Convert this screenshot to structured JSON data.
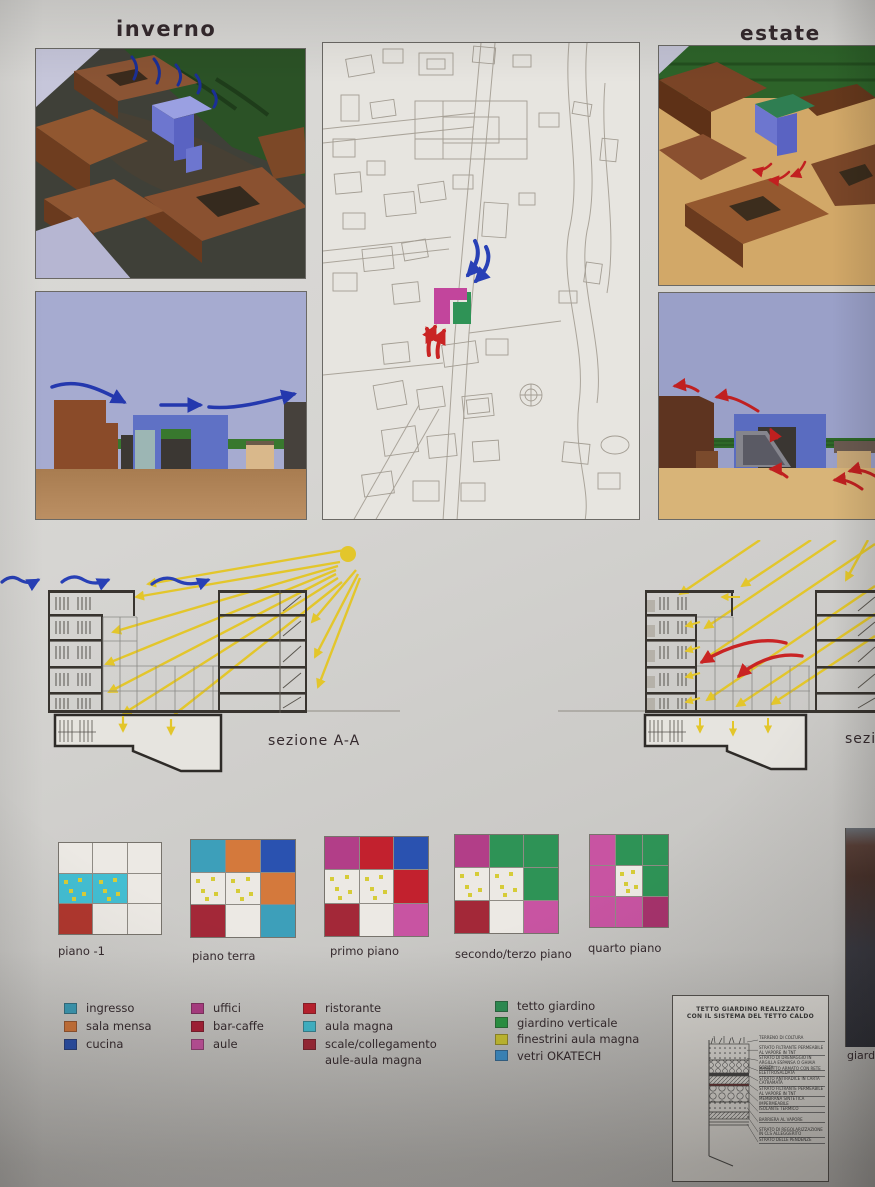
{
  "labels": {
    "winter": "inverno",
    "summer": "estate",
    "section_left": "sezione  A-A",
    "section_right": "sezione",
    "right_caption": "giardino verticale"
  },
  "floor_plans": {
    "plans": [
      {
        "label": "piano -1",
        "cells": [
          "white",
          "white",
          "white",
          "cyan*",
          "cyan*",
          "white",
          "brick",
          "white",
          "white"
        ]
      },
      {
        "label": "piano terra",
        "cells": [
          "teal",
          "orange",
          "blue",
          "white*",
          "white*",
          "orange",
          "darkred",
          "white",
          "teal"
        ]
      },
      {
        "label": "primo piano",
        "cells": [
          "magenta",
          "red",
          "blue",
          "white*",
          "white*",
          "red",
          "darkred",
          "white",
          "pink"
        ]
      },
      {
        "label": "secondo/terzo piano",
        "cells": [
          "magenta",
          "green",
          "green",
          "white*",
          "white*",
          "green",
          "darkred",
          "white",
          "pink"
        ]
      },
      {
        "label": "quarto piano",
        "cells": [
          "pink",
          "green",
          "green",
          "pink",
          "white*",
          "green",
          "pink",
          "pink",
          "plum"
        ]
      }
    ]
  },
  "palette": {
    "white": "#ece9e4",
    "teal": "#3d9fba",
    "orange": "#d4793c",
    "blue": "#2a52b0",
    "magenta": "#b23e88",
    "red": "#c2212e",
    "darkred": "#a32838",
    "pink": "#c854a2",
    "cyan": "#43bed2",
    "green": "#2e9356",
    "brick": "#b0372e",
    "plum": "#a6336c",
    "dot": "#d6cc38"
  },
  "legend": {
    "columns": [
      {
        "items": [
          {
            "label": "ingresso",
            "color": "#3d9fba"
          },
          {
            "label": "sala mensa",
            "color": "#d4793c"
          },
          {
            "label": "cucina",
            "color": "#2a52b0"
          }
        ]
      },
      {
        "items": [
          {
            "label": "uffici",
            "color": "#b23e88"
          },
          {
            "label": "bar-caffe",
            "color": "#ad2038"
          },
          {
            "label": "aule",
            "color": "#c854a2"
          }
        ]
      },
      {
        "items": [
          {
            "label": "ristorante",
            "color": "#c2212e"
          },
          {
            "label": "aula magna",
            "color": "#43bed2"
          },
          {
            "label": "scale/collegamento",
            "label2": "aule-aula magna",
            "color": "#a32838"
          }
        ]
      },
      {
        "items": [
          {
            "label": "tetto giardino",
            "color": "#2e9356"
          },
          {
            "label": "giardino verticale",
            "color": "#2b9b45"
          },
          {
            "label": "finestrini aula magna",
            "color": "#cfc832"
          },
          {
            "label": "vetri  OKATECH",
            "color": "#3e93cf"
          }
        ]
      }
    ]
  },
  "detail_box": {
    "title1": "TETTO GIARDINO REALIZZATO",
    "title2": "CON IL SISTEMA DEL TETTO CALDO",
    "layers": [
      "TERRENO DI COLTURA",
      "STRATO FILTRANTE PERMEABILE AL VAPORE IN TNT",
      "STRATO DI DRENAGGIO IN ARGILLA ESPANSA O GHIAIA SCELTA",
      "MASSETTO ARMATO CON RETE ELETTROSALDATA",
      "STRATO ANTIRADICE IN CARTA CATRAMATA",
      "STRATO FILTRANTE PERMEABILE AL VAPORE IN TNT",
      "MEMBRANA SINTETICA IMPERMEABILE",
      "ISOLANTE TERMICO",
      "BARRIERA AL VAPORE",
      "STRATO DI REGOLARIZZAZIONE IN CLS ALLEGGERITO",
      "STRATO DELLE PENDENZE"
    ]
  }
}
